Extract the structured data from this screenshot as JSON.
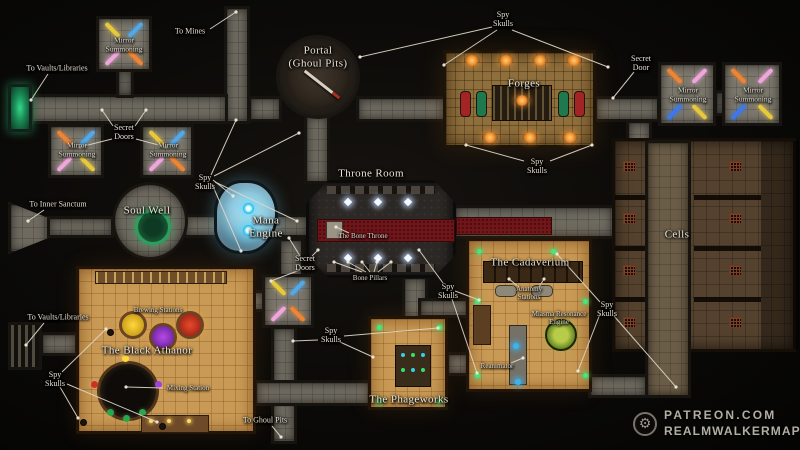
{
  "watermark": {
    "site": "Patreon.com",
    "name": "RealmwalkerMaps"
  },
  "colors": {
    "background": "#0b0a08",
    "corridor_stone": "#6e6a60",
    "room_orange": "#c99a55",
    "forge_floor": "#8f6f3c",
    "cells_brown": "#55422e",
    "carpet_red": "#701519",
    "soul_well_green": "#2ba05e",
    "mana_blue": "#35c4f0",
    "spy_skull_green": "#43e87c",
    "label_text": "#e4dfd1",
    "leader_line": "#ddd7c7"
  },
  "labels": [
    {
      "id": "to-mines",
      "text": "To Mines",
      "x": 190,
      "y": 31,
      "kind": "small",
      "leaders": [
        [
          210,
          29,
          236,
          12
        ]
      ]
    },
    {
      "id": "to-vaults-top",
      "text": "To Vaults/Libraries",
      "x": 57,
      "y": 68,
      "kind": "small",
      "leaders": [
        [
          48,
          74,
          31,
          100
        ]
      ]
    },
    {
      "id": "mirror-summoning-1",
      "text": "Mirror\nSummoning",
      "x": 124,
      "y": 45,
      "kind": "roomsmall"
    },
    {
      "id": "secret-doors-west",
      "text": "Secret\nDoors",
      "x": 124,
      "y": 132,
      "kind": "small",
      "leaders": [
        [
          113,
          126,
          102,
          110
        ],
        [
          135,
          126,
          146,
          110
        ],
        [
          112,
          139,
          80,
          147
        ],
        [
          136,
          139,
          166,
          147
        ]
      ]
    },
    {
      "id": "mirror-summoning-2",
      "text": "Mirror\nSummoning",
      "x": 77,
      "y": 150,
      "kind": "roomsmall"
    },
    {
      "id": "mirror-summoning-3",
      "text": "Mirror\nSummoning",
      "x": 168,
      "y": 150,
      "kind": "roomsmall"
    },
    {
      "id": "spy-skulls-top",
      "text": "Spy\nSkulls",
      "x": 503,
      "y": 19,
      "kind": "small",
      "leaders": [
        [
          492,
          27,
          360,
          57
        ],
        [
          497,
          30,
          444,
          65
        ],
        [
          512,
          30,
          608,
          67
        ]
      ]
    },
    {
      "id": "portal",
      "text": "Portal\n(Ghoul Pits)",
      "x": 318,
      "y": 57,
      "kind": "room"
    },
    {
      "id": "forges",
      "text": "Forges",
      "x": 524,
      "y": 84,
      "kind": "room"
    },
    {
      "id": "secret-door-east",
      "text": "Secret\nDoor",
      "x": 641,
      "y": 63,
      "kind": "small",
      "leaders": [
        [
          634,
          72,
          613,
          98
        ]
      ]
    },
    {
      "id": "mirror-summoning-4",
      "text": "Mirror\nSummoning",
      "x": 688,
      "y": 95,
      "kind": "roomsmall"
    },
    {
      "id": "mirror-summoning-5",
      "text": "Mirror\nSummoning",
      "x": 753,
      "y": 95,
      "kind": "roomsmall"
    },
    {
      "id": "spy-skulls-forge",
      "text": "Spy\nSkulls",
      "x": 537,
      "y": 166,
      "kind": "small",
      "leaders": [
        [
          524,
          161,
          466,
          145
        ],
        [
          550,
          161,
          592,
          145
        ]
      ]
    },
    {
      "id": "spy-skulls-west",
      "text": "Spy\nSkulls",
      "x": 205,
      "y": 182,
      "kind": "small",
      "leaders": [
        [
          211,
          175,
          236,
          120
        ],
        [
          214,
          176,
          299,
          133
        ],
        [
          213,
          180,
          233,
          196
        ],
        [
          212,
          184,
          241,
          251
        ],
        [
          215,
          182,
          297,
          221
        ]
      ]
    },
    {
      "id": "soul-well",
      "text": "Soul Well",
      "x": 147,
      "y": 211,
      "kind": "room"
    },
    {
      "id": "mana-engine",
      "text": "Mana\nEngine",
      "x": 266,
      "y": 227,
      "kind": "room"
    },
    {
      "id": "to-inner-sanctum",
      "text": "To Inner Sanctum",
      "x": 58,
      "y": 204,
      "kind": "small",
      "leaders": [
        [
          44,
          210,
          28,
          221
        ]
      ]
    },
    {
      "id": "throne-room",
      "text": "Throne Room",
      "x": 371,
      "y": 174,
      "kind": "room"
    },
    {
      "id": "bone-throne",
      "text": "The Bone Throne",
      "x": 363,
      "y": 236,
      "kind": "tiny",
      "leaders": [
        [
          349,
          233,
          336,
          227
        ]
      ]
    },
    {
      "id": "bone-pillars",
      "text": "Bone Pillars",
      "x": 370,
      "y": 278,
      "kind": "tiny",
      "leaders": [
        [
          362,
          272,
          334,
          262
        ],
        [
          366,
          272,
          348,
          262
        ],
        [
          370,
          272,
          362,
          262
        ],
        [
          374,
          272,
          377,
          262
        ],
        [
          378,
          272,
          391,
          262
        ]
      ]
    },
    {
      "id": "secret-doors-throne",
      "text": "Secret\nDoors",
      "x": 305,
      "y": 263,
      "kind": "small",
      "leaders": [
        [
          300,
          256,
          289,
          238
        ],
        [
          300,
          270,
          271,
          281
        ],
        [
          312,
          256,
          318,
          250
        ]
      ]
    },
    {
      "id": "cells",
      "text": "Cells",
      "x": 677,
      "y": 235,
      "kind": "room"
    },
    {
      "id": "cadaverium",
      "text": "The Cadaverium",
      "x": 530,
      "y": 263,
      "kind": "room"
    },
    {
      "id": "anatomy-stations",
      "text": "Anatomy\nStations",
      "x": 529,
      "y": 293,
      "kind": "tiny",
      "leaders": [
        [
          519,
          287,
          509,
          279
        ],
        [
          539,
          287,
          544,
          279
        ]
      ]
    },
    {
      "id": "miasma-engine",
      "text": "Miasma Resonance\nEngine",
      "x": 559,
      "y": 318,
      "kind": "tiny"
    },
    {
      "id": "reanimator",
      "text": "Reanimator",
      "x": 497,
      "y": 366,
      "kind": "tiny",
      "leaders": [
        [
          511,
          363,
          523,
          358
        ]
      ]
    },
    {
      "id": "spy-skulls-cadaverium",
      "text": "Spy\nSkulls",
      "x": 448,
      "y": 291,
      "kind": "small",
      "leaders": [
        [
          443,
          283,
          419,
          250
        ],
        [
          455,
          291,
          479,
          300
        ],
        [
          452,
          299,
          477,
          373
        ]
      ]
    },
    {
      "id": "spy-skulls-cells",
      "text": "Spy\nSkulls",
      "x": 607,
      "y": 309,
      "kind": "small",
      "leaders": [
        [
          600,
          302,
          557,
          254
        ],
        [
          600,
          314,
          578,
          371
        ],
        [
          614,
          316,
          676,
          387
        ]
      ]
    },
    {
      "id": "to-vaults-bottom",
      "text": "To Vaults/Libraries",
      "x": 58,
      "y": 317,
      "kind": "small",
      "leaders": [
        [
          44,
          323,
          26,
          345
        ]
      ]
    },
    {
      "id": "black-athanor",
      "text": "The Black Athanor",
      "x": 147,
      "y": 351,
      "kind": "room"
    },
    {
      "id": "brewing-stations",
      "text": "Brewing Stations",
      "x": 158,
      "y": 310,
      "kind": "tiny"
    },
    {
      "id": "mixing-station",
      "text": "Mixing Station",
      "x": 188,
      "y": 388,
      "kind": "tiny",
      "leaders": [
        [
          163,
          388,
          126,
          387
        ]
      ]
    },
    {
      "id": "spy-skulls-athanor",
      "text": "Spy\nSkulls",
      "x": 55,
      "y": 379,
      "kind": "small",
      "leaders": [
        [
          62,
          372,
          106,
          329
        ],
        [
          60,
          387,
          78,
          418
        ],
        [
          67,
          384,
          157,
          422
        ]
      ]
    },
    {
      "id": "spy-skulls-phageworks",
      "text": "Spy\nSkulls",
      "x": 331,
      "y": 335,
      "kind": "small",
      "leaders": [
        [
          318,
          340,
          293,
          341
        ],
        [
          340,
          342,
          373,
          357
        ],
        [
          344,
          336,
          438,
          328
        ]
      ]
    },
    {
      "id": "phageworks",
      "text": "The Phageworks",
      "x": 409,
      "y": 400,
      "kind": "room"
    },
    {
      "id": "to-ghoul-pits",
      "text": "To Ghoul Pits",
      "x": 265,
      "y": 420,
      "kind": "small",
      "leaders": [
        [
          272,
          426,
          281,
          437
        ]
      ]
    }
  ]
}
